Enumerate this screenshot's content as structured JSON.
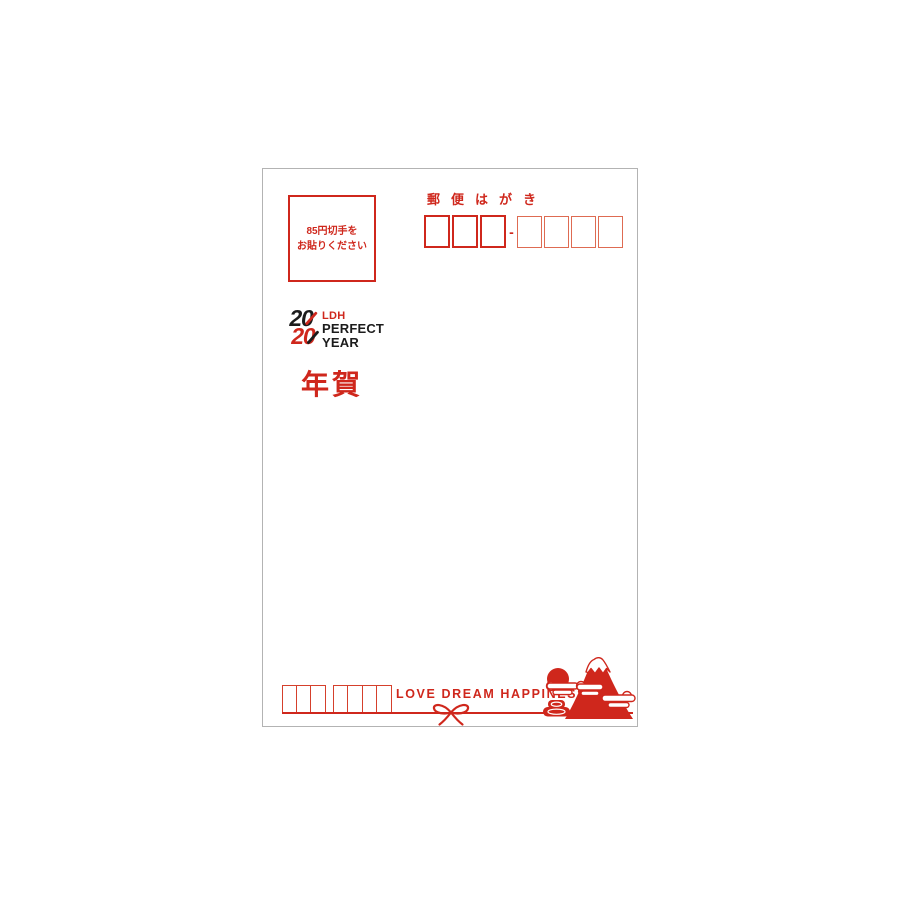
{
  "postcard": {
    "stamp_box": {
      "line1": "85円切手を",
      "line2": "お貼りください"
    },
    "header_title": "郵便はがき",
    "recipient_postal_code": {
      "separator": "-",
      "boxes_before_separator": 3,
      "boxes_after_separator": 4
    },
    "logo": {
      "top_number": "20",
      "bottom_number": "20",
      "brand": "LDH",
      "word1": "PERFECT",
      "word2": "YEAR"
    },
    "greeting_label": "年賀",
    "sender_postal_code": {
      "boxes_group1": 3,
      "boxes_group2": 4
    },
    "slogan": "LOVE DREAM HAPPINESS",
    "illustration": {
      "elements": [
        "sun",
        "mount-fuji",
        "snow-cap",
        "clouds",
        "rice-bales",
        "ribbon-bow"
      ]
    },
    "colors": {
      "primary_red": "#cf271c",
      "light_red": "#de6b52",
      "black": "#1c1c1c",
      "card_border": "#b3b3b3",
      "background": "#ffffff"
    }
  }
}
